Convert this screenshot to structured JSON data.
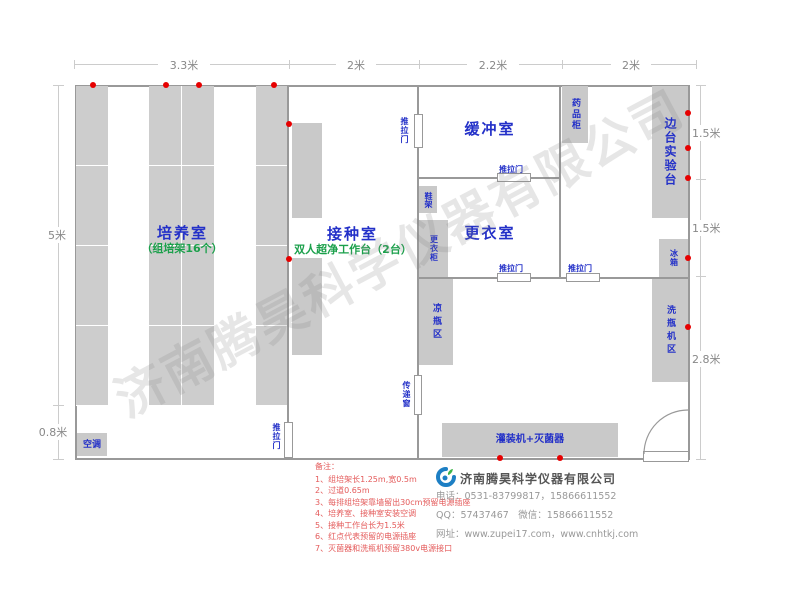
{
  "watermark": "济南腾昊科学仪器有限公司",
  "dimensions": {
    "top": [
      "3.3米",
      "2米",
      "2.2米",
      "2米"
    ],
    "left": [
      "5米",
      "0.8米"
    ],
    "right": [
      "1.5米",
      "1.5米",
      "2.8米"
    ]
  },
  "rooms": {
    "cultivation": "培养室",
    "cultivation_sub": "（组培架16个）",
    "inoculation": "接种室",
    "inoculation_sub": "双人超净工作台（2台）",
    "buffer": "缓冲室",
    "changing": "更衣室"
  },
  "furniture": {
    "air_conditioner": "空调",
    "medicine_cabinet": "药品柜",
    "side_bench": "边台实验台",
    "fridge": "冰箱",
    "shoe_rack": "鞋架",
    "wardrobe": "更衣柜",
    "cooling_area": "凉瓶区",
    "washer_area": "洗瓶机区",
    "filling_machine": "灌装机+灭菌器"
  },
  "doors": {
    "sliding": "推拉门",
    "transfer": "传递窗"
  },
  "notes": {
    "title": "备注：",
    "items": [
      "1、组培架长1.25m,宽0.5m",
      "2、过道0.65m",
      "3、每排组培架靠墙留出30cm预留电源插座",
      "4、培养室、接种室安装空调",
      "5、接种工作台长为1.5米",
      "6、红点代表预留的电源插座",
      "7、灭菌器和洗瓶机预留380v电源接口"
    ]
  },
  "company": {
    "name": "济南腾昊科学仪器有限公司",
    "phone": "电话：0531-83799817，15866611552",
    "qq": "QQ：57437467　微信：15866611552",
    "web": "网址：www.zupei17.com，www.cnhtkj.com"
  },
  "colors": {
    "room_label": "#2330c8",
    "sub_label": "#1ba04b",
    "note_red": "#e45b5b",
    "dot_red": "#e60000",
    "wall": "#999999"
  }
}
